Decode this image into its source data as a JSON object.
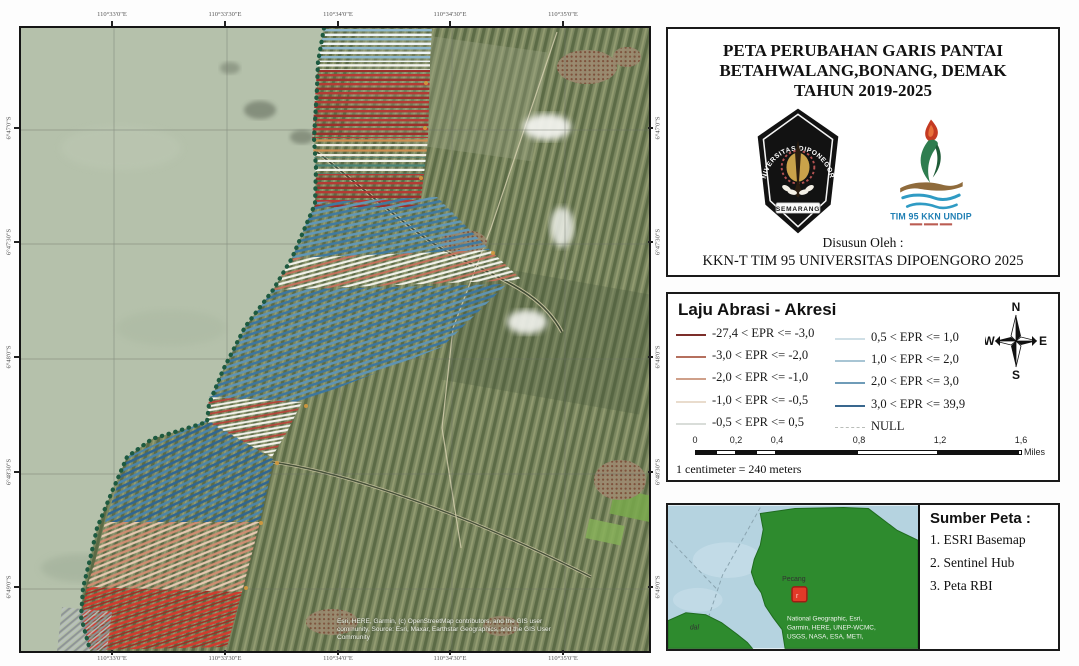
{
  "map": {
    "lon_labels": [
      "110°33'0\"E",
      "110°33'30\"E",
      "110°34'0\"E",
      "110°34'30\"E",
      "110°35'0\"E"
    ],
    "lat_labels": [
      "6°47'0\"S",
      "6°47'30\"S",
      "6°48'0\"S",
      "6°48'30\"S",
      "6°49'0\"S"
    ],
    "attribution_lines": [
      "Esri, HERE, Garmin, (c) OpenStreetMap contributors, and the GIS user",
      "community, Source: Esri, Maxar, Earthstar Geographics, and the GIS User",
      "Community"
    ]
  },
  "title_panel": {
    "title_line1": "PETA PERUBAHAN GARIS PANTAI",
    "title_line2": "BETAHWALANG,BONANG, DEMAK",
    "title_line3": "TAHUN 2019-2025",
    "undip_logo_arc_text": "UNIVERSITAS DIPONEGORO",
    "undip_logo_banner": "SEMARANG",
    "tim_logo_text": "TIM 95 KKN UNDIP",
    "author_label": "Disusun Oleh :",
    "author": "KKN-T TIM 95 UNIVERSITAS DIPOENGORO 2025"
  },
  "legend_panel": {
    "heading": "Laju Abrasi - Akresi",
    "items_left": [
      {
        "label": "-27,4 < EPR <= -3,0",
        "color": "#7c2e2a"
      },
      {
        "label": "-3,0 < EPR <= -2,0",
        "color": "#b5705e"
      },
      {
        "label": "-2,0 < EPR <= -1,0",
        "color": "#cfa08a"
      },
      {
        "label": "-1,0 < EPR <= -0,5",
        "color": "#e9dccd"
      },
      {
        "label": "-0,5 < EPR <= 0,5",
        "color": "#d9ddd9"
      }
    ],
    "items_right": [
      {
        "label": "0,5 < EPR <= 1,0",
        "color": "#cfdfe6"
      },
      {
        "label": "1,0 < EPR <= 2,0",
        "color": "#a8c5d4"
      },
      {
        "label": "2,0 < EPR <= 3,0",
        "color": "#6f9cb8"
      },
      {
        "label": "3,0 < EPR <= 39,9",
        "color": "#39678e"
      },
      {
        "label": "NULL",
        "color": "#c9cdc9"
      }
    ],
    "compass": {
      "n": "N",
      "s": "S",
      "e": "E",
      "w": "W"
    },
    "scale_labels": [
      "0",
      "0,2",
      "0,4",
      "0,8",
      "1,2",
      "1,6"
    ],
    "scale_unit": "Miles",
    "scale_note": "1 centimeter = 240 meters"
  },
  "inset_panel": {
    "place_label_1": "Pecang",
    "place_label_2": "dal",
    "inset_attribution_lines": [
      "National Geographic, Esri,",
      "Garmin, HERE, UNEP-WCMC,",
      "USGS, NASA, ESA, METI,"
    ],
    "sources_heading": "Sumber Peta :",
    "sources": [
      "1. ESRI  Basemap",
      "2. Sentinel Hub",
      "3. Peta RBI"
    ]
  }
}
